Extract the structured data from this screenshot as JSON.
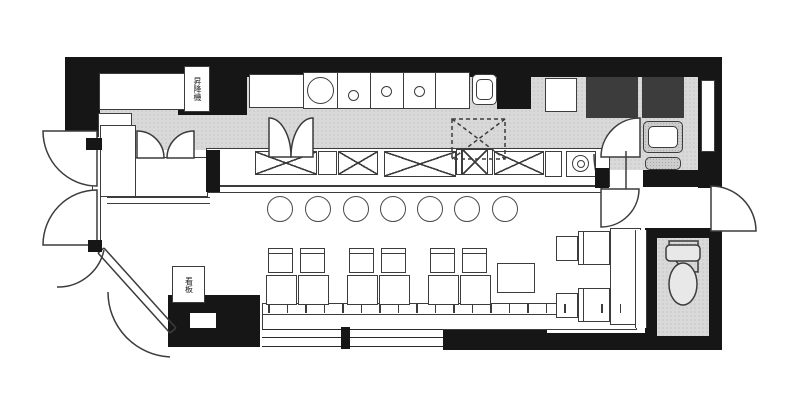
{
  "document": {
    "kind": "scanned restaurant floor plan",
    "orientation": "landscape"
  },
  "palette": {
    "wall_black": "#161616",
    "line_gray": "#3c3c3c",
    "kitchen_floor_gray": "#d9d9d9",
    "equipment_gray": "#cdcdcd",
    "paper_white": "#ffffff"
  },
  "text_labels": {
    "wall_shaft_label": "昇降機",
    "entrance_sign_label": "看板"
  },
  "fixtures": {
    "counter_stools": {
      "count": 7,
      "r": 13,
      "cy": 209,
      "cx": [
        280,
        318,
        356,
        393,
        430,
        467,
        505
      ]
    },
    "counter_equipment_boxes": [
      {
        "x": 255,
        "y": 151,
        "w": 62,
        "h": 24
      },
      {
        "x": 338,
        "y": 151,
        "w": 40,
        "h": 24
      },
      {
        "x": 384,
        "y": 151,
        "w": 72,
        "h": 26
      },
      {
        "x": 462,
        "y": 149,
        "w": 26,
        "h": 26
      },
      {
        "x": 494,
        "y": 151,
        "w": 50,
        "h": 24
      }
    ],
    "counter_dividers": [
      {
        "x": 318,
        "y": 151,
        "w": 19,
        "h": 24
      },
      {
        "x": 456,
        "y": 149,
        "w": 6,
        "h": 26
      },
      {
        "x": 487,
        "y": 149,
        "w": 6,
        "h": 26
      },
      {
        "x": 545,
        "y": 151,
        "w": 17,
        "h": 26
      }
    ],
    "storage_xboxes": [
      {
        "x": 586,
        "y": 77,
        "w": 52,
        "h": 41
      },
      {
        "x": 642,
        "y": 77,
        "w": 42,
        "h": 41
      }
    ],
    "dining_groups": {
      "group_x": [
        266,
        347,
        428
      ],
      "pair_offsets": [
        0,
        32
      ],
      "table": {
        "y": 275,
        "w": 31,
        "h": 30
      },
      "chair": {
        "y": 248,
        "w": 25,
        "h": 25
      }
    },
    "bench_ticks": {
      "x_start": 268,
      "x_end": 630,
      "step": 18.5,
      "y": 304,
      "h": 9
    },
    "burners": {
      "d": 11,
      "centers": [
        [
          353,
          95
        ],
        [
          386,
          91
        ],
        [
          419,
          91
        ]
      ]
    },
    "stockpot": {
      "cx": 320,
      "cy": 90,
      "d": 27
    }
  }
}
